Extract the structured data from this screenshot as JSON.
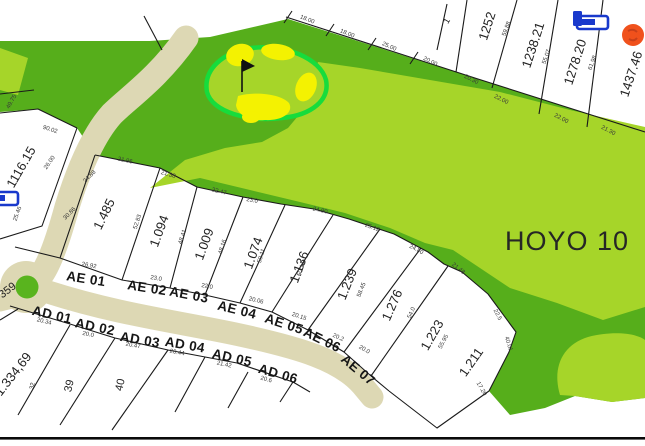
{
  "landmark": {
    "text": "HOYO 10"
  },
  "colors": {
    "rough_green": "#56ae1b",
    "fairway_green": "#a6d529",
    "green_ring": "#17dc3c",
    "bunker_yellow": "#f4f201",
    "road_beige": "#ddd8b4",
    "marker_orange": "#f0511c",
    "marker_blue": "#1939cc",
    "line_black": "#1a1a1a"
  },
  "icons": [
    "flag-icon",
    "bed-icon",
    "bed-icon",
    "round-marker-icon"
  ],
  "labels": {
    "street_names_ae": {
      "items": [
        {
          "t": "AE 01",
          "x": 86,
          "y": 279,
          "r": 9
        },
        {
          "t": "AE 02",
          "x": 147,
          "y": 288,
          "r": 9
        },
        {
          "t": "AE 03",
          "x": 189,
          "y": 295,
          "r": 11
        },
        {
          "t": "AE 04",
          "x": 237,
          "y": 310,
          "r": 14
        },
        {
          "t": "AE 05",
          "x": 284,
          "y": 324,
          "r": 18
        },
        {
          "t": "AE 06",
          "x": 322,
          "y": 340,
          "r": 26
        },
        {
          "t": "AE 07",
          "x": 358,
          "y": 370,
          "r": 40
        }
      ]
    },
    "street_names_ad": {
      "items": [
        {
          "t": "AD 01",
          "x": 52,
          "y": 315,
          "r": 13
        },
        {
          "t": "AD 02",
          "x": 95,
          "y": 327,
          "r": 12
        },
        {
          "t": "AD 03",
          "x": 140,
          "y": 340,
          "r": 10
        },
        {
          "t": "AD 04",
          "x": 185,
          "y": 345,
          "r": 10
        },
        {
          "t": "AD 05",
          "x": 232,
          "y": 358,
          "r": 13
        },
        {
          "t": "AD 06",
          "x": 278,
          "y": 374,
          "r": 16
        }
      ]
    },
    "lot_areas": {
      "items": [
        {
          "t": "1.485",
          "x": 104,
          "y": 214,
          "r": -64
        },
        {
          "t": "1.094",
          "x": 159,
          "y": 231,
          "r": -70
        },
        {
          "t": "1.009",
          "x": 204,
          "y": 244,
          "r": -70
        },
        {
          "t": "1.074",
          "x": 253,
          "y": 253,
          "r": -70
        },
        {
          "t": "1.136",
          "x": 299,
          "y": 267,
          "r": -70
        },
        {
          "t": "1.239",
          "x": 347,
          "y": 284,
          "r": -68
        },
        {
          "t": "1.276",
          "x": 392,
          "y": 305,
          "r": -66
        },
        {
          "t": "1.223",
          "x": 432,
          "y": 335,
          "r": -60
        },
        {
          "t": "1.211",
          "x": 471,
          "y": 362,
          "r": -55
        },
        {
          "t": "1252",
          "x": 487,
          "y": 26,
          "r": -72
        },
        {
          "t": "1238.21",
          "x": 533,
          "y": 45,
          "r": -72
        },
        {
          "t": "1278.20",
          "x": 575,
          "y": 62,
          "r": -72
        },
        {
          "t": "1437.46",
          "x": 631,
          "y": 74,
          "r": -72
        },
        {
          "t": "1116.15",
          "x": 21,
          "y": 167,
          "r": -60
        },
        {
          "t": "1.334,69",
          "x": 13,
          "y": 374,
          "r": -52
        }
      ]
    },
    "lot_numbers": {
      "items": [
        {
          "t": "359",
          "x": 8,
          "y": 291,
          "r": -38
        },
        {
          "t": "39",
          "x": 70,
          "y": 386,
          "r": -78
        },
        {
          "t": "40",
          "x": 121,
          "y": 385,
          "r": -78
        },
        {
          "t": "32",
          "x": 33,
          "y": 386,
          "r": -78,
          "s": 6
        },
        {
          "t": "1",
          "x": 447,
          "y": 21,
          "r": -60,
          "s": 9
        }
      ]
    },
    "dimensions": {
      "items": [
        {
          "t": "18.00",
          "x": 307,
          "y": 20,
          "r": 22
        },
        {
          "t": "18.00",
          "x": 347,
          "y": 34,
          "r": 22
        },
        {
          "t": "25.00",
          "x": 389,
          "y": 47,
          "r": 24
        },
        {
          "t": "20.00",
          "x": 430,
          "y": 62,
          "r": 26
        },
        {
          "t": "20.30",
          "x": 471,
          "y": 80,
          "r": 27
        },
        {
          "t": "22.00",
          "x": 501,
          "y": 100,
          "r": 27
        },
        {
          "t": "22.00",
          "x": 561,
          "y": 119,
          "r": 28
        },
        {
          "t": "21.30",
          "x": 608,
          "y": 131,
          "r": 28
        },
        {
          "t": "59.88",
          "x": 507,
          "y": 29,
          "r": -70
        },
        {
          "t": "55.07",
          "x": 547,
          "y": 57,
          "r": -70
        },
        {
          "t": "61.98",
          "x": 593,
          "y": 63,
          "r": -70
        },
        {
          "t": "21.96",
          "x": 125,
          "y": 161,
          "r": 12
        },
        {
          "t": "21.38",
          "x": 168,
          "y": 175,
          "r": 16
        },
        {
          "t": "22.47",
          "x": 219,
          "y": 192,
          "r": 14
        },
        {
          "t": "23.0",
          "x": 252,
          "y": 201,
          "r": 10
        },
        {
          "t": "24.90",
          "x": 320,
          "y": 211,
          "r": 12
        },
        {
          "t": "25.12",
          "x": 372,
          "y": 228,
          "r": 20
        },
        {
          "t": "24.80",
          "x": 416,
          "y": 250,
          "r": 28
        },
        {
          "t": "21.48",
          "x": 458,
          "y": 269,
          "r": 38
        },
        {
          "t": "22.5",
          "x": 497,
          "y": 315,
          "r": 62
        },
        {
          "t": "40.01",
          "x": 508,
          "y": 344,
          "r": 72
        },
        {
          "t": "17.20",
          "x": 481,
          "y": 389,
          "r": 60
        },
        {
          "t": "52.83",
          "x": 138,
          "y": 222,
          "r": -72
        },
        {
          "t": "48.41",
          "x": 183,
          "y": 237,
          "r": -72
        },
        {
          "t": "48.16",
          "x": 223,
          "y": 247,
          "r": -72
        },
        {
          "t": "50.11",
          "x": 262,
          "y": 256,
          "r": -72
        },
        {
          "t": "50.14",
          "x": 302,
          "y": 269,
          "r": -72
        },
        {
          "t": "58.45",
          "x": 362,
          "y": 290,
          "r": -68
        },
        {
          "t": "54.0",
          "x": 412,
          "y": 313,
          "r": -66
        },
        {
          "t": "55.95",
          "x": 444,
          "y": 342,
          "r": -62
        },
        {
          "t": "26.92",
          "x": 89,
          "y": 266,
          "r": 10
        },
        {
          "t": "23.0",
          "x": 156,
          "y": 279,
          "r": 10
        },
        {
          "t": "22.0",
          "x": 207,
          "y": 287,
          "r": 10
        },
        {
          "t": "20.06",
          "x": 256,
          "y": 301,
          "r": 14
        },
        {
          "t": "20.15",
          "x": 299,
          "y": 317,
          "r": 18
        },
        {
          "t": "20.2",
          "x": 338,
          "y": 338,
          "r": 24
        },
        {
          "t": "20.0",
          "x": 364,
          "y": 350,
          "r": 30
        },
        {
          "t": "20.34",
          "x": 44,
          "y": 322,
          "r": 14
        },
        {
          "t": "20.0",
          "x": 88,
          "y": 335,
          "r": 12
        },
        {
          "t": "20.47",
          "x": 133,
          "y": 346,
          "r": 10
        },
        {
          "t": "20.44",
          "x": 177,
          "y": 353,
          "r": 10
        },
        {
          "t": "21.42",
          "x": 224,
          "y": 365,
          "r": 12
        },
        {
          "t": "20.6",
          "x": 266,
          "y": 380,
          "r": 16
        },
        {
          "t": "26.00",
          "x": 50,
          "y": 163,
          "r": -55
        },
        {
          "t": "24.88",
          "x": 90,
          "y": 177,
          "r": -45
        },
        {
          "t": "30.86",
          "x": 70,
          "y": 214,
          "r": -45
        },
        {
          "t": "25.46",
          "x": 18,
          "y": 214,
          "r": -70
        },
        {
          "t": "90.02",
          "x": 50,
          "y": 130,
          "r": 18
        },
        {
          "t": "49.75",
          "x": 12,
          "y": 102,
          "r": -60
        }
      ]
    }
  }
}
